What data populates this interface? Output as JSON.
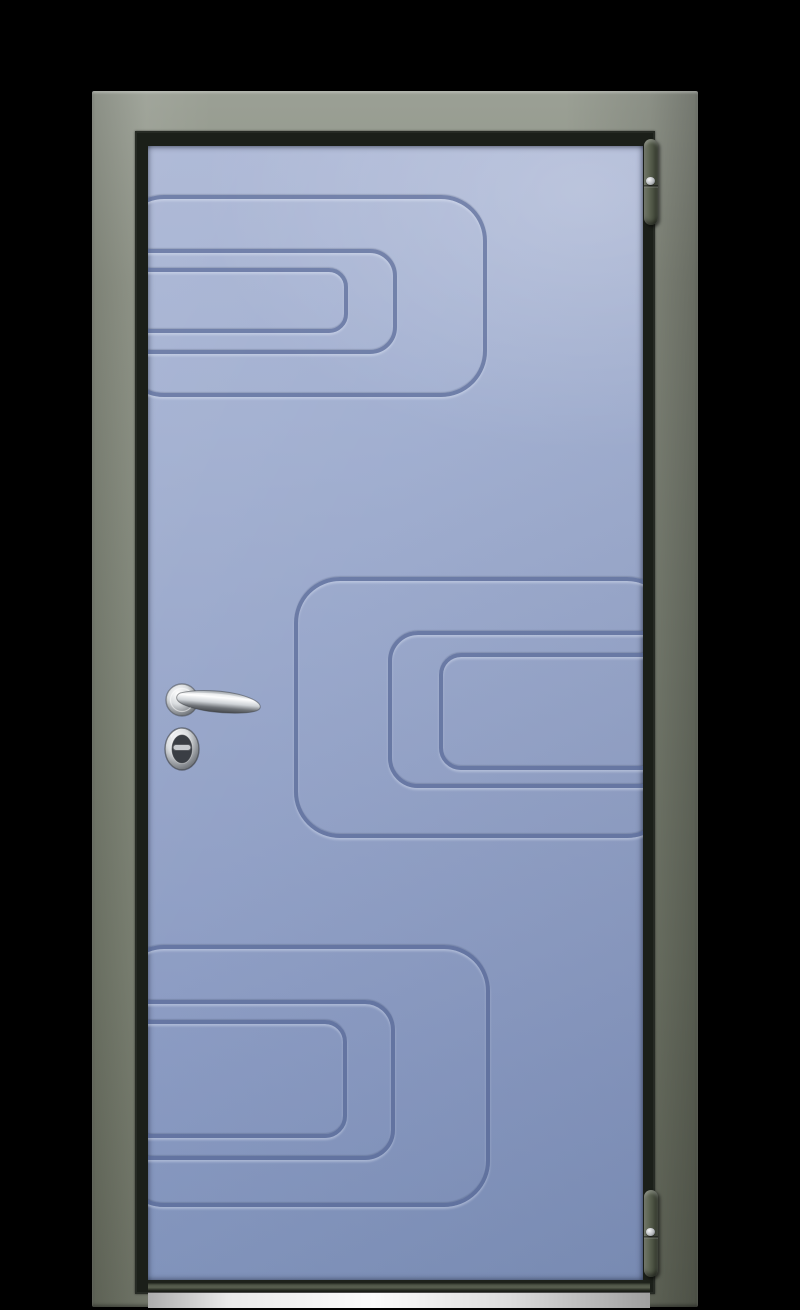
{
  "scene": {
    "type": "product-photo",
    "subject": "closed entry door, front view",
    "elements": [
      "door-frame",
      "door-leaf",
      "milled-groove-pattern",
      "lever-handle",
      "lock-cylinder",
      "top-hinge",
      "bottom-hinge",
      "threshold-sill"
    ]
  },
  "colors": {
    "background": "#000000",
    "frame": "#7f8577",
    "frame_light": "#9ba095",
    "frame_dark": "#676c5e",
    "frame_gap": "#1b1f19",
    "leaf_top": "#a7b3d3",
    "leaf_bottom": "#7f92bb",
    "groove_line": "#4f6090",
    "hinge_light": "#7b8171",
    "hinge_dark": "#343a2d",
    "chrome_light": "#f6f7f8",
    "chrome_dark": "#5f6368",
    "threshold_light": "#fbfbfb",
    "threshold_dark": "#9f9f9f"
  },
  "pattern": {
    "groups": [
      {
        "name": "top-group-opens-left",
        "rects": [
          {
            "left": -30,
            "top": 49,
            "width": 369,
            "height": 202,
            "radius": 46
          },
          {
            "left": -30,
            "top": 103,
            "width": 279,
            "height": 105,
            "radius": 27
          },
          {
            "left": -30,
            "top": 122,
            "width": 230,
            "height": 65,
            "radius": 19
          }
        ]
      },
      {
        "name": "middle-group-opens-right",
        "rects": [
          {
            "left": 146,
            "top": 431,
            "width": 379,
            "height": 261,
            "radius": 46
          },
          {
            "left": 240,
            "top": 485,
            "width": 285,
            "height": 157,
            "radius": 30
          },
          {
            "left": 291,
            "top": 507,
            "width": 234,
            "height": 117,
            "radius": 22
          }
        ]
      },
      {
        "name": "bottom-group-opens-left",
        "rects": [
          {
            "left": -30,
            "top": 799,
            "width": 372,
            "height": 262,
            "radius": 46
          },
          {
            "left": -30,
            "top": 854,
            "width": 277,
            "height": 160,
            "radius": 30
          },
          {
            "left": -30,
            "top": 874,
            "width": 229,
            "height": 118,
            "radius": 22
          }
        ]
      }
    ]
  }
}
